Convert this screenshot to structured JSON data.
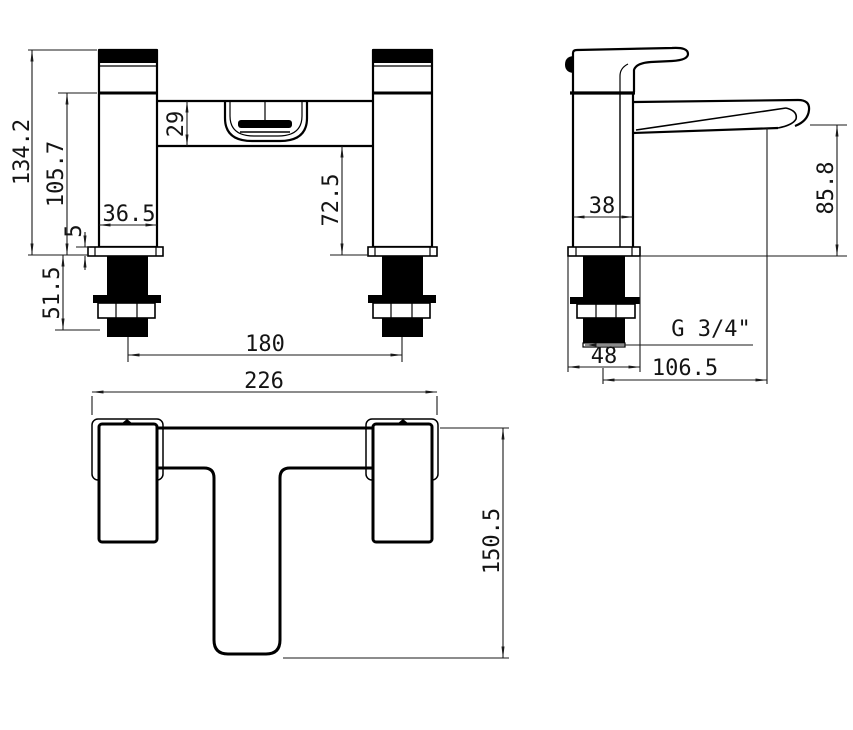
{
  "meta": {
    "title": "Bath filler tap dimensioned technical drawing",
    "background_color": "#ffffff",
    "line_color": "#000000",
    "views": [
      "front elevation",
      "side elevation",
      "plan"
    ]
  },
  "front_view": {
    "dims": {
      "total_height": "134.2",
      "body_height": "105.7",
      "manifold_height": "29",
      "spout_clearance": "72.5",
      "base_plate_thickness": "5",
      "body_width": "36.5",
      "tail_length": "51.5",
      "hole_centres": "180"
    }
  },
  "side_view": {
    "dims": {
      "body_depth": "38",
      "spout_height": "85.8",
      "thread_size": "G 3/4\"",
      "base_depth": "48",
      "spout_reach": "106.5"
    }
  },
  "plan_view": {
    "dims": {
      "overall_width": "226",
      "overall_depth": "150.5"
    }
  }
}
